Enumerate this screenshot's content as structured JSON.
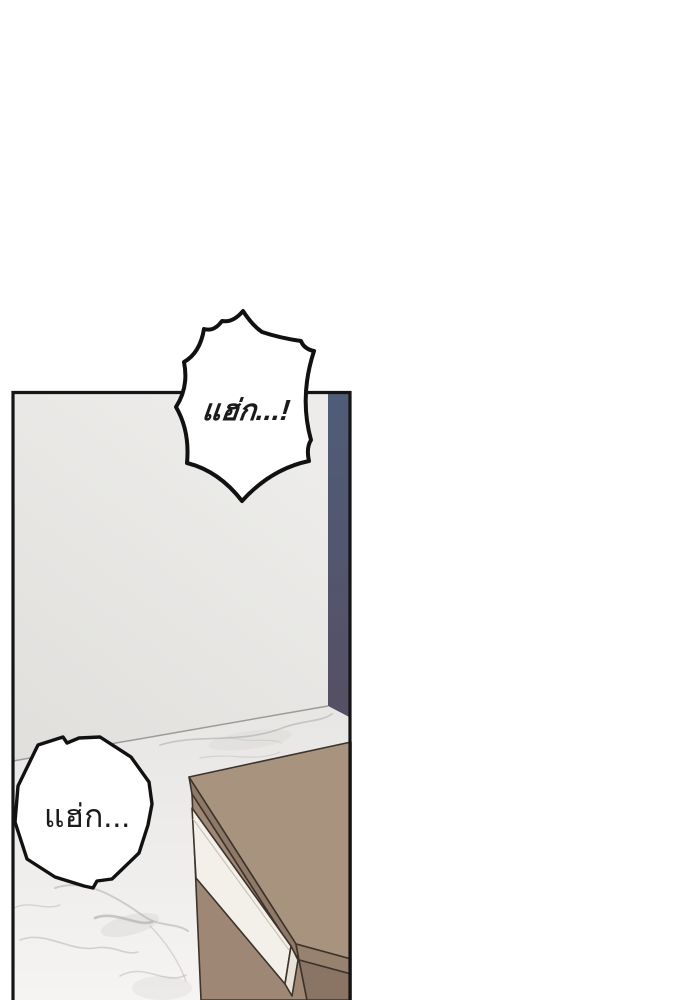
{
  "page": {
    "background": "#ffffff"
  },
  "comic": {
    "panel": {
      "border_color": "#151515",
      "wall": {
        "top": "#edecea",
        "bottom": "#e0dfdc"
      },
      "accent_wall": {
        "top": "#4f5d78",
        "bottom": "#564f63"
      },
      "floor": {
        "base_far": "#e7e6e4",
        "base_near": "#f5f4f2",
        "vein_color": "#a9a8a6",
        "junction_line": "#9b9b99"
      }
    },
    "furniture": {
      "name": "nightstand",
      "top": "#a8937f",
      "edge_left": "#8e7968",
      "edge_right": "#97826f",
      "side_left": "#9e8875",
      "side_right": "#8a7463",
      "drawer": "#f3f0ea",
      "drawer_cap": "#e7e2da",
      "drawer_seam": "#c9c3ba",
      "outline": "#3e332a"
    },
    "bubbles": {
      "burst": {
        "text": "แฮ่ก...!",
        "fill": "#ffffff",
        "stroke": "#111111"
      },
      "round": {
        "text": "แฮ่ก...",
        "fill": "#ffffff",
        "stroke": "#111111"
      }
    },
    "ink_color": "#1b1b1b"
  }
}
